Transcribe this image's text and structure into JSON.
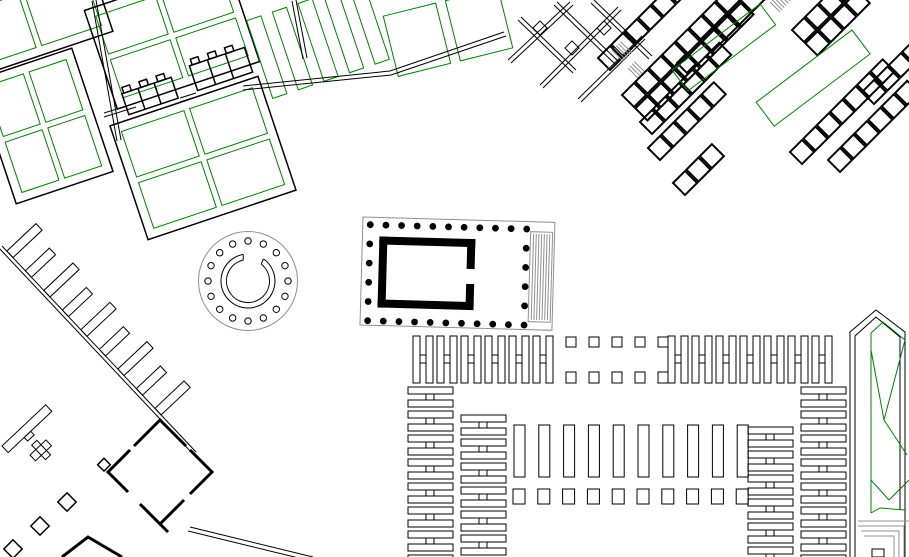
{
  "page": {
    "title": "archaeological-site-plan",
    "description": "black-and-white excavation plan with green planted plots"
  },
  "colors": {
    "background": "#ffffff",
    "ink": "#000000",
    "green": "#008000",
    "gray": "#909090"
  },
  "legend_semantics": {
    "black-lines": "excavated walls",
    "green-lines": "garden plots / planted areas",
    "gray-lines": "restored or minor structures",
    "black-dots": "temple columns"
  },
  "geo": {
    "temple": {
      "tilt": 1.6,
      "tilt_cx": 363,
      "tilt_cy": 217,
      "outer": [
        363,
        217,
        192,
        108
      ],
      "stairs": [
        531,
        227,
        22,
        90
      ],
      "stair_lines": 7,
      "dot_r": 3.4,
      "row_x0": 370.5,
      "row_step": 15.65,
      "row_count": 11,
      "row_y_top": 224.5,
      "row_y_bot": 320.5,
      "col_x_left": 370.5,
      "col_x_right": 527,
      "col_y0": 224.5,
      "col_step": 19.2,
      "col_count": 6,
      "cella": [
        [
          380,
          236,
          8,
          71
        ],
        [
          380,
          236,
          96,
          8
        ],
        [
          380,
          299,
          96,
          8
        ],
        [
          468,
          236,
          8,
          30
        ],
        [
          468,
          281,
          8,
          26
        ]
      ]
    },
    "tholos": {
      "cx": 248,
      "cy": 281,
      "outer_r": 49.5,
      "col_ring_r": 40,
      "col_r": 3.2,
      "col_count": 16,
      "col_start_deg": -90,
      "col_step_deg": 22.5
    },
    "housing": {
      "angle": -18.5,
      "blocks": [
        {
          "cx": 30,
          "cy": 20,
          "w": 150,
          "h": 74,
          "cols": 2,
          "rows": 1
        },
        {
          "cx": 44,
          "cy": 126,
          "w": 102,
          "h": 130,
          "cols": 2,
          "rows": 2
        },
        {
          "cx": 172,
          "cy": 36,
          "w": 150,
          "h": 104,
          "cols": 2,
          "rows": 2
        },
        {
          "cx": 203,
          "cy": 158,
          "w": 156,
          "h": 120,
          "cols": 2,
          "rows": 2
        }
      ],
      "strips": {
        "cx": 318,
        "cy": 40,
        "count": 5,
        "w": 15,
        "h": 82,
        "step": 27
      },
      "quads": {
        "cx": 448,
        "cy": 32,
        "angle": -14,
        "w": 54,
        "h": 62,
        "gap": 10,
        "count": 2
      }
    },
    "ladders": {
      "h_rows": [
        {
          "x0": 413,
          "y": 336,
          "count": 6,
          "period": 24
        },
        {
          "x0": 668,
          "y": 336,
          "count": 7,
          "period": 24
        }
      ],
      "v_cols": [
        {
          "x": 408,
          "y0": 387,
          "count": 8,
          "period": 24
        },
        {
          "x": 461,
          "y0": 415,
          "count": 7,
          "period": 24
        },
        {
          "x": 801,
          "y0": 387,
          "count": 8,
          "period": 24
        },
        {
          "x": 748,
          "y0": 427,
          "count": 6,
          "period": 24
        }
      ]
    },
    "pillar_rows": [
      {
        "x0": 566,
        "y": 337,
        "count": 5,
        "step": 23,
        "w": 10,
        "h": 10
      },
      {
        "x0": 566,
        "y": 372,
        "count": 5,
        "step": 23,
        "w": 10,
        "h": 11
      }
    ],
    "stalls": {
      "x0": 514,
      "y": 425,
      "count": 10,
      "step": 24.8,
      "w": 11,
      "h": 52
    },
    "sq_row": {
      "x0": 513,
      "y": 489,
      "count": 10,
      "step": 24.8,
      "w": 12,
      "h": 15
    },
    "comb": {
      "p1": [
        2,
        246
      ],
      "p2": [
        196,
        452
      ],
      "offset": 3.6,
      "teeth_t0": 16,
      "teeth_dt": 27,
      "teeth_count": 9,
      "teeth_len_a": 40,
      "teeth_len_b": 33,
      "teeth_w": 9,
      "teeth_angle": -43.3
    },
    "diamonds": {
      "centers": [
        [
          67,
          502
        ],
        [
          40,
          526
        ],
        [
          13,
          549
        ]
      ],
      "size": 13
    },
    "room_bands": [
      {
        "x": 598,
        "y": 58,
        "count": 6,
        "rows": 1
      },
      {
        "x": 622,
        "y": 95,
        "count": 8,
        "rows": 2
      },
      {
        "x": 640,
        "y": 122,
        "count": 6,
        "rows": 1
      },
      {
        "x": 648,
        "y": 148,
        "count": 5,
        "rows": 1
      },
      {
        "x": 673,
        "y": 183,
        "count": 3,
        "rows": 1
      },
      {
        "x": 700,
        "y": 40,
        "count": 4,
        "rows": 1
      },
      {
        "x": 790,
        "y": 152,
        "count": 7,
        "rows": 1
      },
      {
        "x": 828,
        "y": 160,
        "count": 6,
        "rows": 1
      },
      {
        "x": 862,
        "y": 92,
        "count": 6,
        "rows": 1
      },
      {
        "x": 792,
        "y": 30,
        "count": 4,
        "rows": 2
      }
    ],
    "room_size": 17,
    "room_step": 19,
    "hatches": [
      {
        "x": 612,
        "y": 50,
        "n": 5,
        "len": 16
      },
      {
        "x": 628,
        "y": 68,
        "n": 4,
        "len": 14
      },
      {
        "x": 770,
        "y": 2,
        "n": 6,
        "len": 14
      }
    ]
  }
}
